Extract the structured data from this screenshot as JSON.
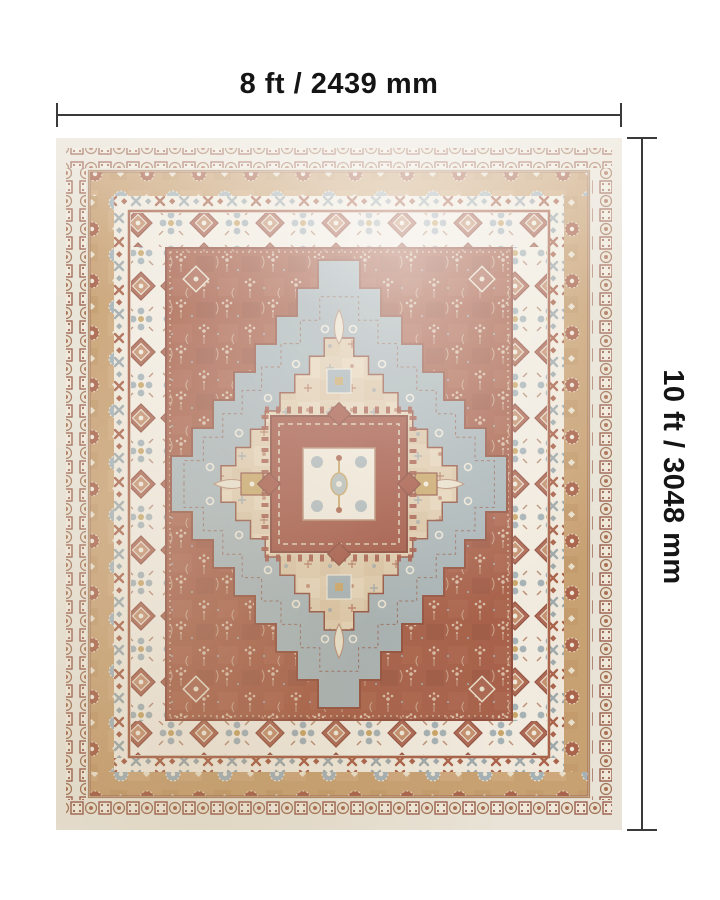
{
  "dimensions": {
    "width_label": "8 ft / 2439 mm",
    "height_label": "10 ft / 3048 mm"
  },
  "rug": {
    "colors": {
      "outer_cream": "#e8e3d6",
      "tan_border": "#c59c6b",
      "border_cream": "#f1ebdf",
      "field_rust": "#a2573f",
      "medallion_rust": "#9c4a37",
      "gray_blue": "#a3b0b3",
      "inner_ground": "#ddc8a8",
      "gold_accent": "#c5a05e",
      "dimension_line": "#3a3a3a",
      "label_text": "#151515"
    }
  }
}
